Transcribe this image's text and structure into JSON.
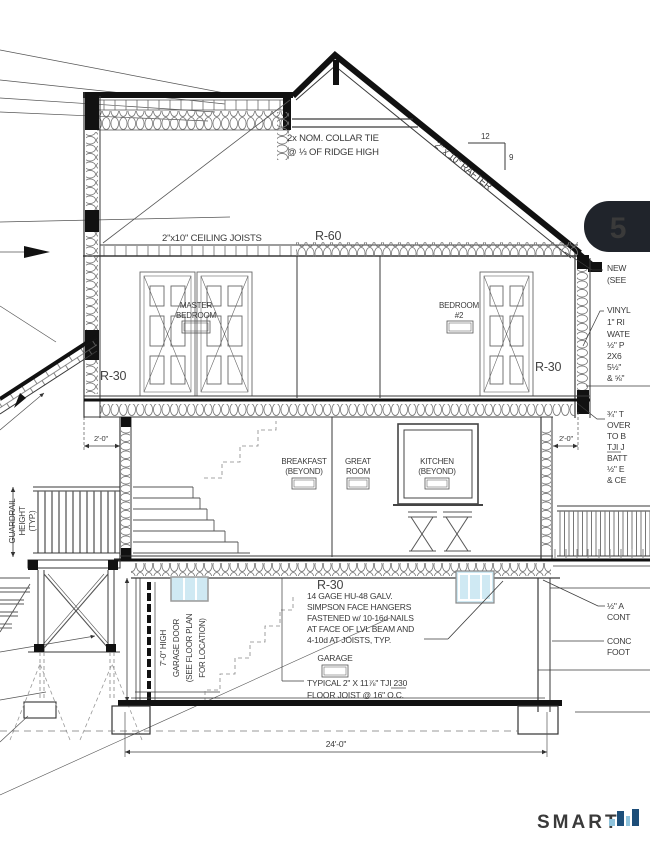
{
  "sheet": {
    "detail_badge": "5",
    "logo_text": "SMART"
  },
  "roof": {
    "collar_tie_note_1": "2x NOM. COLLAR TIE",
    "collar_tie_note_2": "@ ⅓ OF RIDGE HIGH",
    "rafter_label": "2\" x 10\" RAFTER",
    "slope_rise": "12",
    "slope_run": "9",
    "ceiling_joist_label": "2\"x10\" CEILING JOISTS",
    "attic_insulation": "R-60"
  },
  "upper_floor": {
    "master_bedroom_1": "MASTER",
    "master_bedroom_2": "BEDROOM",
    "bedroom2_1": "BEDROOM",
    "bedroom2_2": "#2",
    "wall_insulation_left": "R-30",
    "wall_insulation_right": "R-30",
    "overhang_dim_left": "2'-0\"",
    "overhang_dim_right": "2'-0\""
  },
  "main_floor": {
    "breakfast_1": "BREAKFAST",
    "breakfast_2": "(BEYOND)",
    "great_room_1": "GREAT",
    "great_room_2": "ROOM",
    "kitchen_1": "KITCHEN",
    "kitchen_2": "(BEYOND)",
    "guardrail_1": "GUARDRAIL",
    "guardrail_2": "HEIGHT",
    "guardrail_3": "(TYP.)"
  },
  "garage": {
    "floor_insulation": "R-30",
    "hanger_note": [
      "14 GAGE HU-48 GALV.",
      "SIMPSON FACE HANGERS",
      "FASTENED w/ 10-16d NAILS",
      "AT FACE OF LVL BEAM AND",
      "4-10d AT JOISTS, TYP."
    ],
    "room_label": "GARAGE",
    "joist_note_1": "TYPICAL 2\" X 11⅞\" TJI 230",
    "joist_note_2": "FLOOR JOIST @ 16\" O.C.",
    "door_note": [
      "7'-0\" HIGH",
      "GARAGE DOOR",
      "(SEE FLOOR PLAN",
      "FOR LOCATION)"
    ],
    "overall_width_dim": "24'-0\""
  },
  "right_notes": {
    "n1": [
      "NEW",
      "(SEE"
    ],
    "n2": [
      "VINYL",
      "1\" RI",
      "WATE",
      "½\" P",
      "2X6",
      "5½\"",
      "& ⅝\""
    ],
    "n3": [
      "¾\" T",
      "OVER",
      "TO B",
      "TJI J",
      "BATT",
      "½\" E",
      "& CE"
    ],
    "n4": [
      "½\" A",
      "CONT"
    ],
    "n5": [
      "CONC",
      "FOOT"
    ]
  },
  "colors": {
    "badge_bg": "#20242b",
    "badge_text": "#ffffff",
    "glass_blue": "#cfe9f3",
    "logo_gray": "#d6d6d6",
    "logo_blue_light": "#8fc3dc",
    "logo_blue_dark": "#1d4e79"
  }
}
